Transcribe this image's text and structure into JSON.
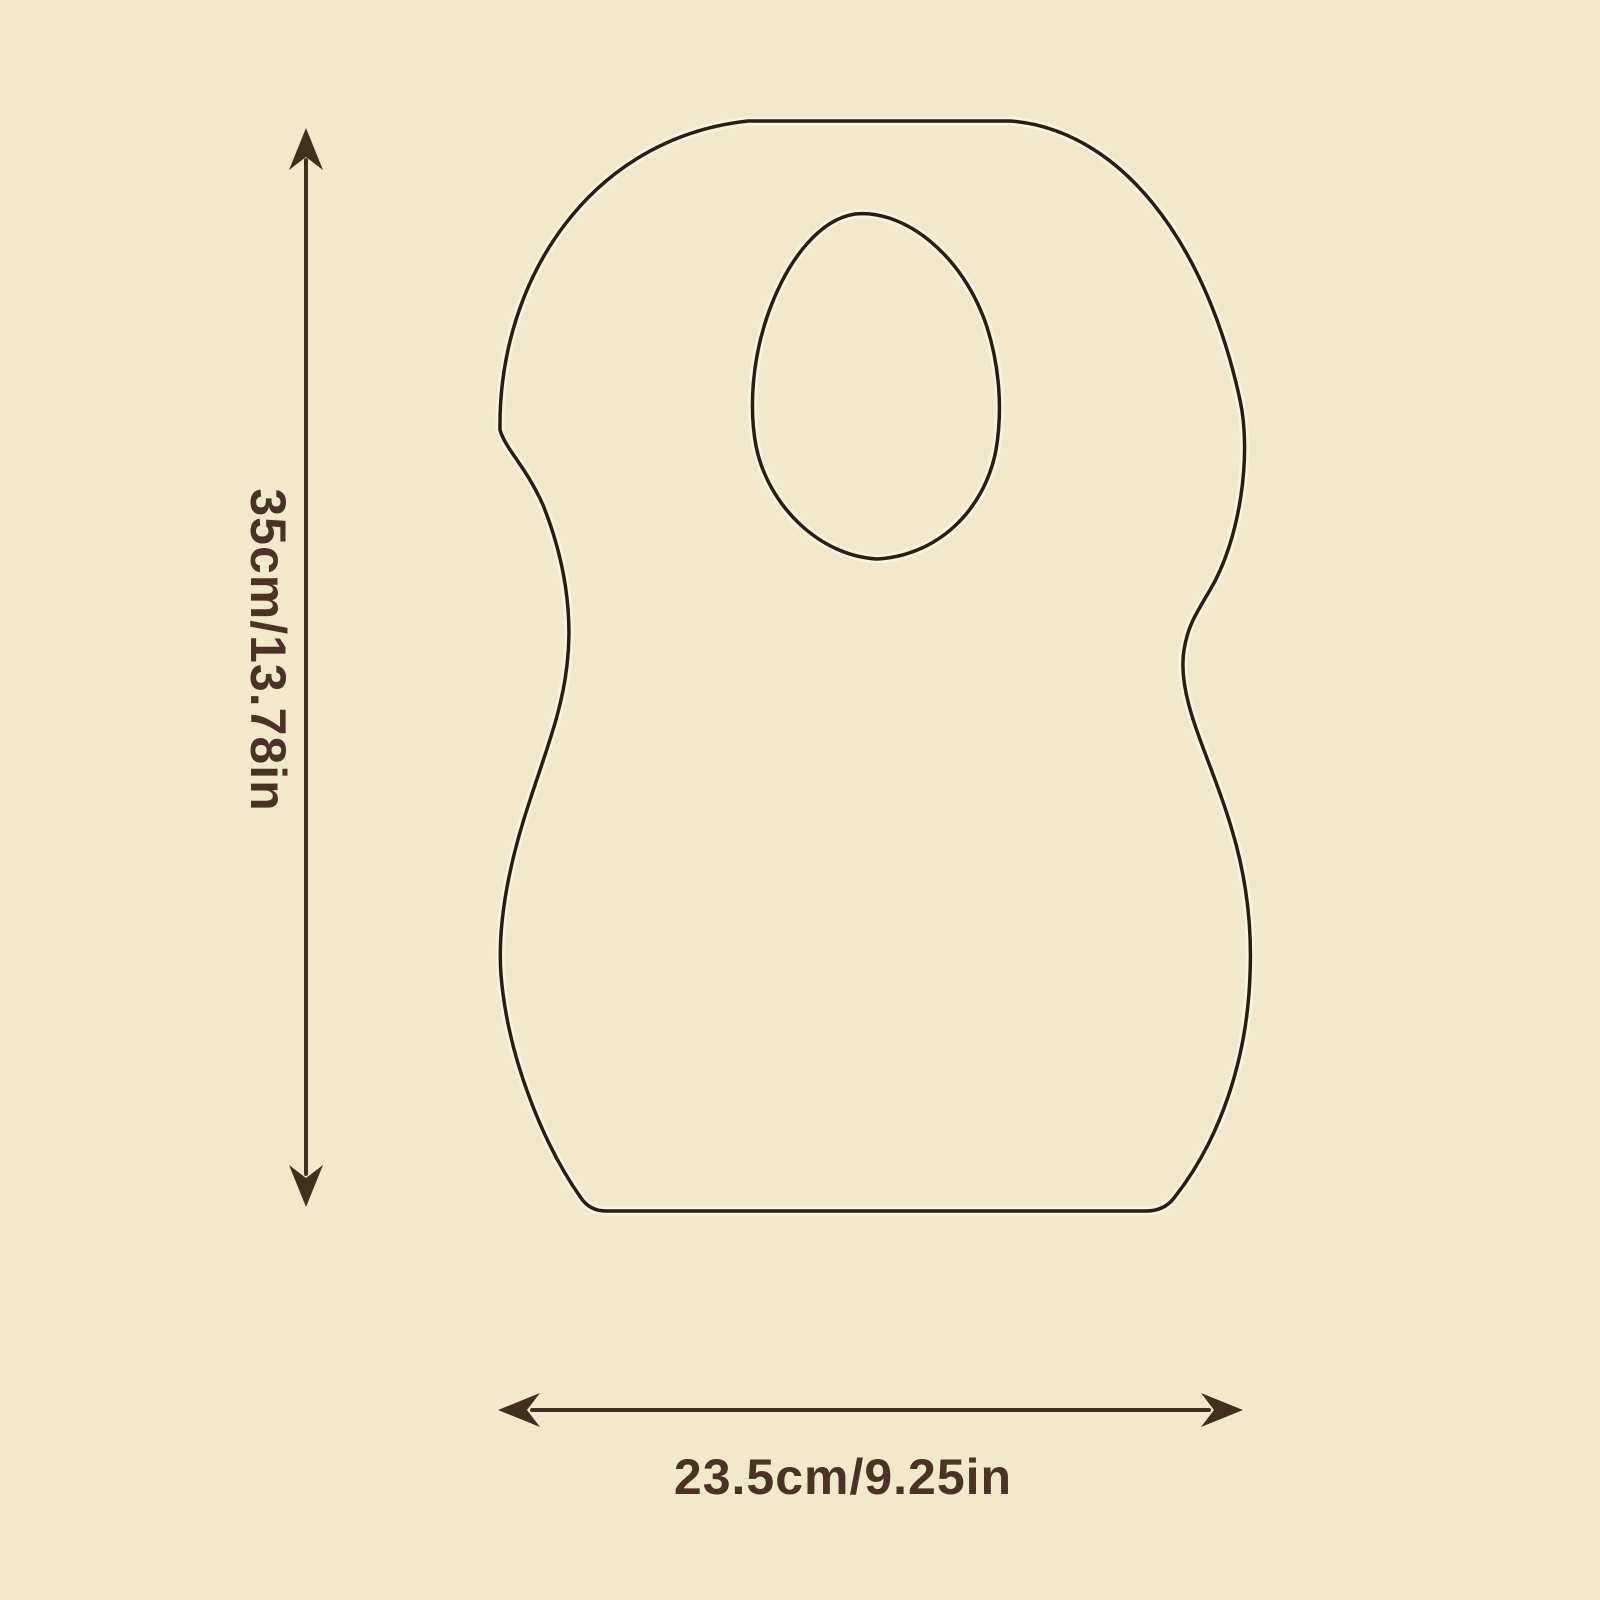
{
  "page": {
    "background_color": "#f2e8cc",
    "ink_color": "#42301f",
    "outline_color": "#2b1d12",
    "label_color": "#4a3324"
  },
  "diagram": {
    "object": "disposable-bib-outline",
    "features": [
      "neck-hole-cutout",
      "flat-bottom",
      "waisted-sides"
    ],
    "dimensions": {
      "height": {
        "label": "35cm/13.78in",
        "cm": 35,
        "in": 13.78,
        "orientation": "vertical",
        "arrow": "double-headed"
      },
      "width": {
        "label": "23.5cm/9.25in",
        "cm": 23.5,
        "in": 9.25,
        "orientation": "horizontal",
        "arrow": "double-headed"
      }
    }
  }
}
